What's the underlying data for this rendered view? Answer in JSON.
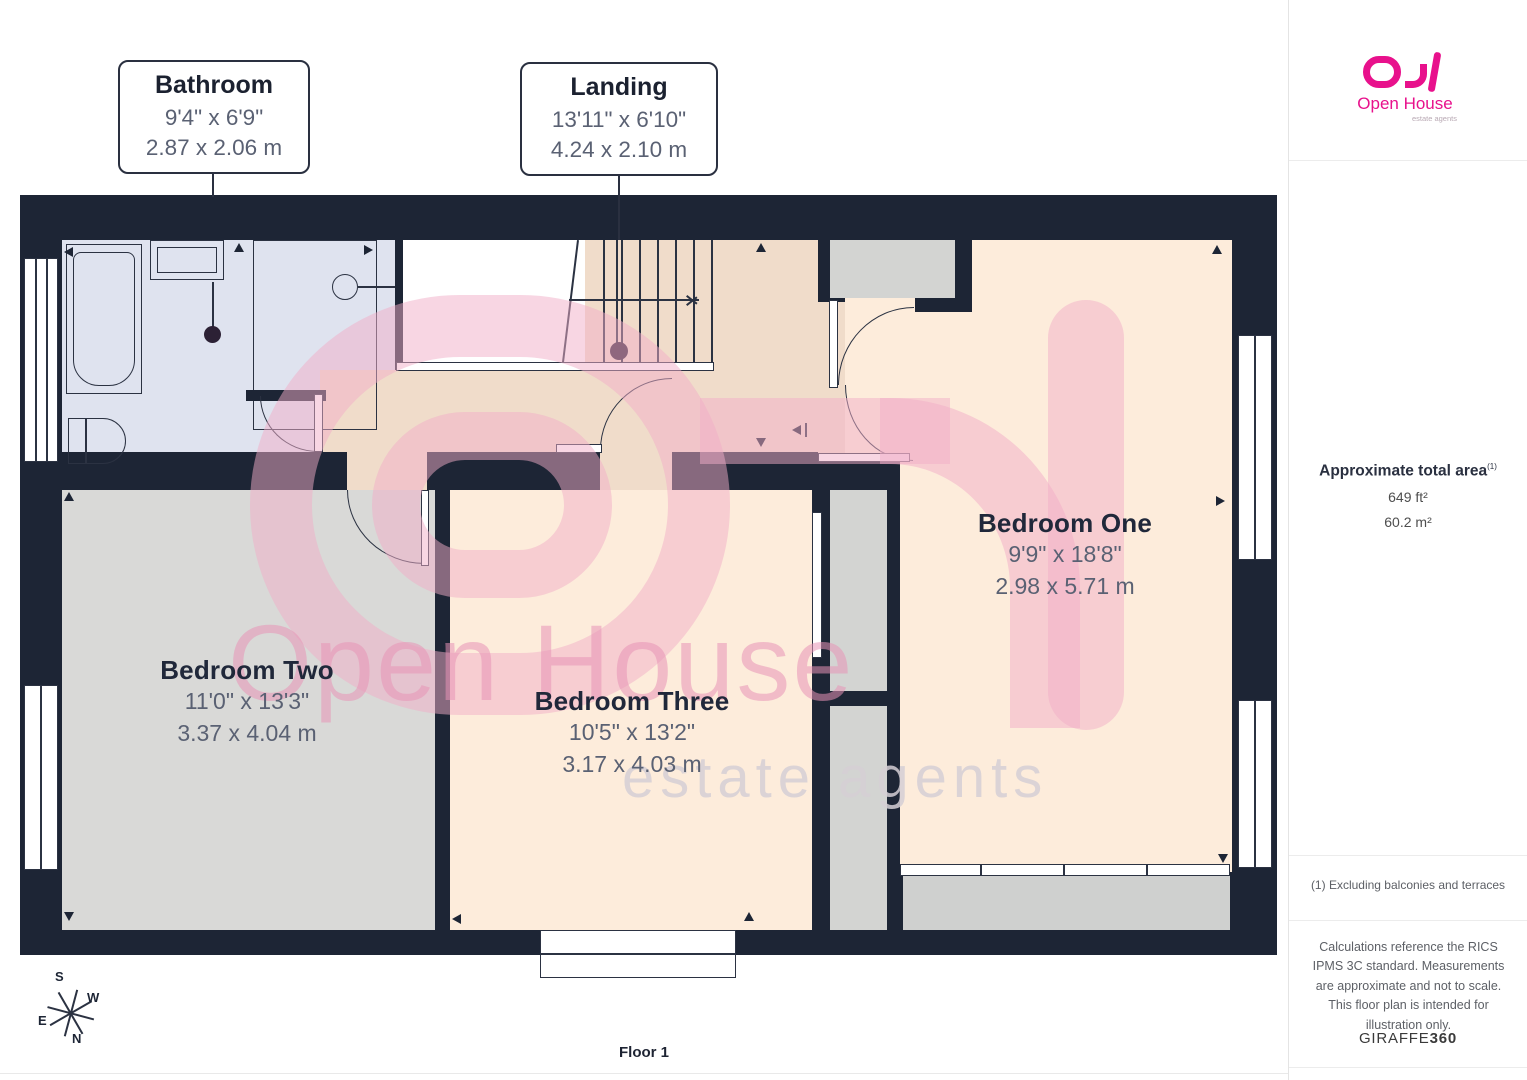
{
  "callouts": [
    {
      "title": "Bathroom",
      "imperial": "9'4\" x 6'9\"",
      "metric": "2.87 x 2.06 m"
    },
    {
      "title": "Landing",
      "imperial": "13'11\" x 6'10\"",
      "metric": "4.24 x 2.10 m"
    }
  ],
  "rooms": [
    {
      "name": "Bedroom Two",
      "imperial": "11'0\" x 13'3\"",
      "metric": "3.37 x 4.04 m"
    },
    {
      "name": "Bedroom Three",
      "imperial": "10'5\" x 13'2\"",
      "metric": "3.17 x 4.03 m"
    },
    {
      "name": "Bedroom One",
      "imperial": "9'9\" x 18'8\"",
      "metric": "2.98 x 5.71 m"
    }
  ],
  "sidebar": {
    "logo": {
      "brand": "Open House",
      "tagline": "estate agents"
    },
    "area": {
      "heading": "Approximate total area",
      "footnote_marker": "(1)",
      "imperial_value": "649 ft²",
      "metric_value": "60.2 m²"
    },
    "footnote": "(1) Excluding balconies and terraces",
    "disclaimer": "Calculations reference the RICS IPMS 3C standard. Measurements are approximate and not to scale. This floor plan is intended for illustration only.",
    "provider": {
      "name": "GIRAFFE",
      "suffix": "360"
    }
  },
  "floor_label": "Floor 1",
  "compass": {
    "n": "N",
    "s": "S",
    "e": "E",
    "w": "W"
  },
  "watermark": {
    "brand": "Open House",
    "tagline": "estate agents"
  },
  "colors": {
    "wall": "#1d2535",
    "bathroom_floor": "#dfe3ef",
    "landing_floor": "#f0dcca",
    "bedroom_peach": "#fdecdb",
    "bedroom_gray": "#d9d9d7",
    "brand_pink": "#e8118c",
    "watermark_pink": "#f2aec8"
  }
}
